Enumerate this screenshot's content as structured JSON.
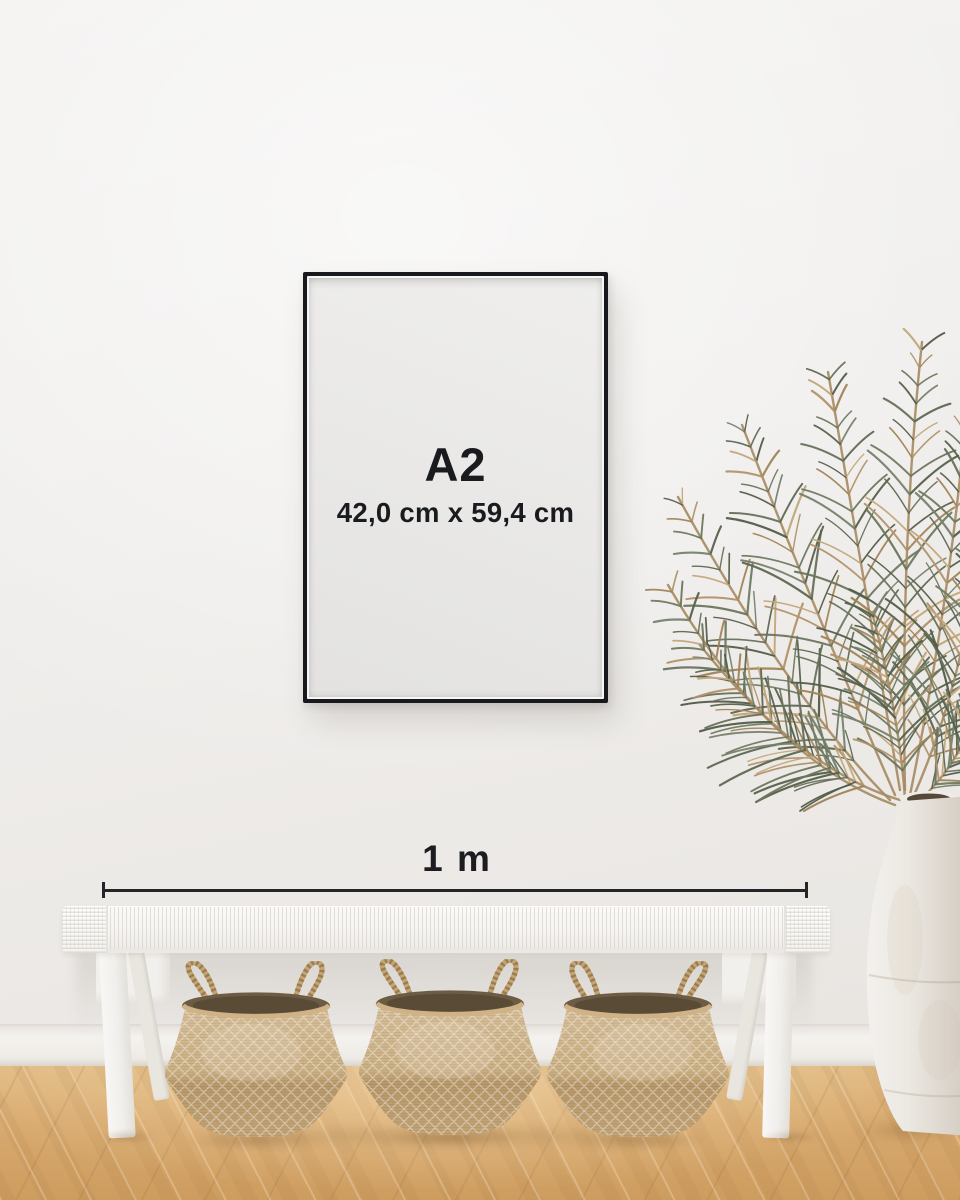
{
  "scene": {
    "poster": {
      "size_label": "A2",
      "dimensions_label": "42,0 cm x 59,4 cm",
      "frame_color": "#17191d",
      "paper_color": "#e9e8e6",
      "text_color": "#1a1b1e"
    },
    "scale_bar": {
      "label": "1 m",
      "line_color": "#232528"
    },
    "colors": {
      "wall": "#efedeb",
      "baseboard": "#f4f2ef",
      "floor_wood": "#d8aa6f",
      "bench": "#f5f4f1",
      "basket_weave": "#c9ae83",
      "basket_interior": "#6d5c44",
      "plant_green": "#5d6751",
      "plant_tan": "#b1926a",
      "vase": "#ece8e2"
    },
    "objects": {
      "basket_count": 3
    }
  }
}
